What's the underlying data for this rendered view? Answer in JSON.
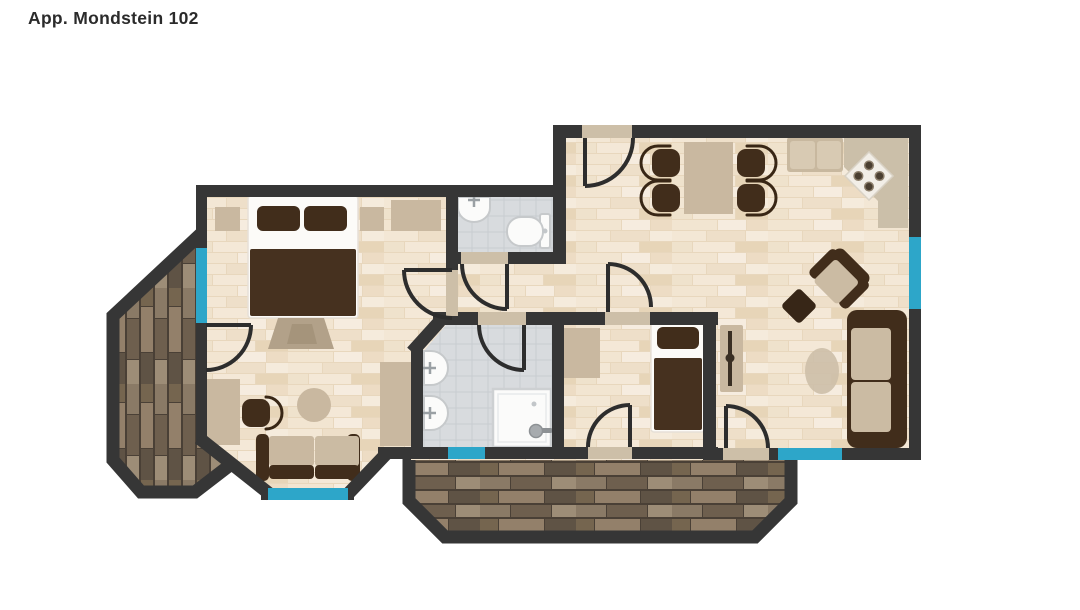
{
  "header": {
    "title": "App. Mondstein 102"
  },
  "floorplan": {
    "colors": {
      "background": "#ffffff",
      "wall": "#363636",
      "window_blue": "#2da6c9",
      "threshold": "#cdbfa8",
      "furniture_dark": "#412d1b",
      "furniture_beige": "#c9b8a0",
      "fixture_white": "#fbfbfa",
      "door_line": "#2d2d2d",
      "wood_floor": "#f2e6d4",
      "tile_floor": "#d8dbde",
      "deck_brown": "#7c6c58"
    }
  }
}
